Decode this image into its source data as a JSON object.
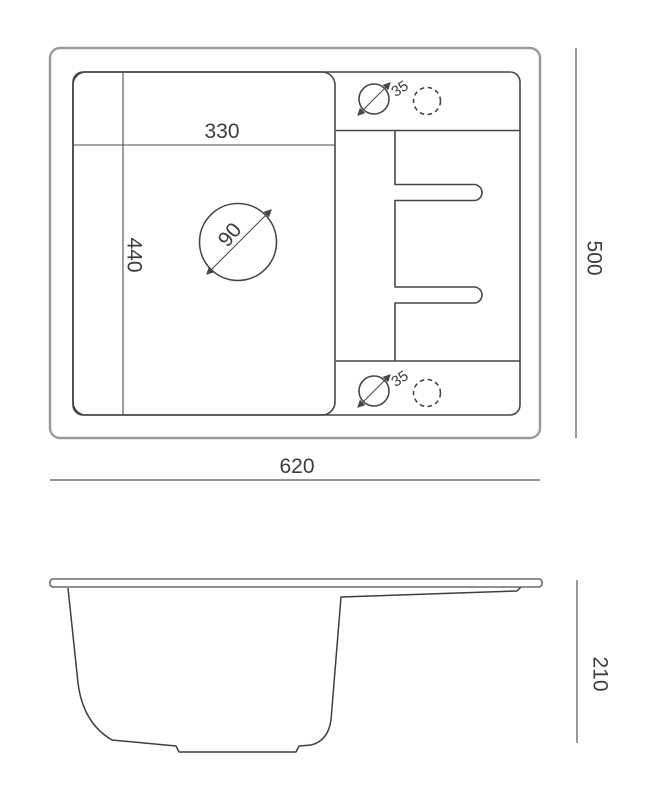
{
  "drawing": {
    "type": "sink-technical-drawing",
    "views": {
      "top_view": {
        "labels": {
          "bowl_width": "330",
          "bowl_depth": "440",
          "drain_diameter": "90",
          "tap_hole_top": "35",
          "tap_hole_bottom": "35",
          "overall_width": "620",
          "overall_depth": "500"
        }
      },
      "side_view": {
        "labels": {
          "height": "210"
        }
      }
    },
    "colors": {
      "background": "#ffffff",
      "outer_rim_line": "#9a9a9a",
      "main_line": "#474747",
      "dimension_line": "#555555",
      "text": "#3d3d3d"
    }
  }
}
